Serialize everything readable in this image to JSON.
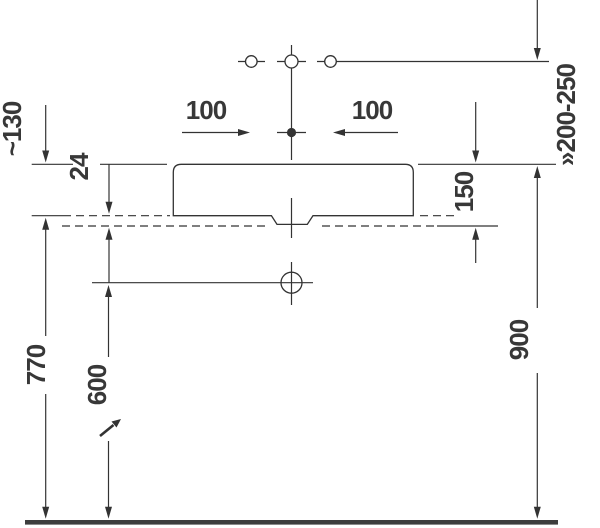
{
  "page": {
    "background": "#ffffff"
  },
  "drawing": {
    "kind": "washbasin installation side elevation",
    "colors": {
      "line": "#333333",
      "text": "#383838",
      "floor": "#3d3d3d"
    },
    "labels": {
      "tap_height": "~130",
      "plate_thickness": "24",
      "hole_spacing_left": "100",
      "hole_spacing_right": "100",
      "rim_to_tap_range": "»200-250",
      "rim_to_plate": "150",
      "floor_to_plate": "770",
      "floor_to_drain": "600",
      "floor_to_rim": "900"
    },
    "dimension_values_visible": [
      "~130",
      "24",
      "100",
      "100",
      "»200-250",
      "150",
      "770",
      "600",
      "900"
    ]
  }
}
